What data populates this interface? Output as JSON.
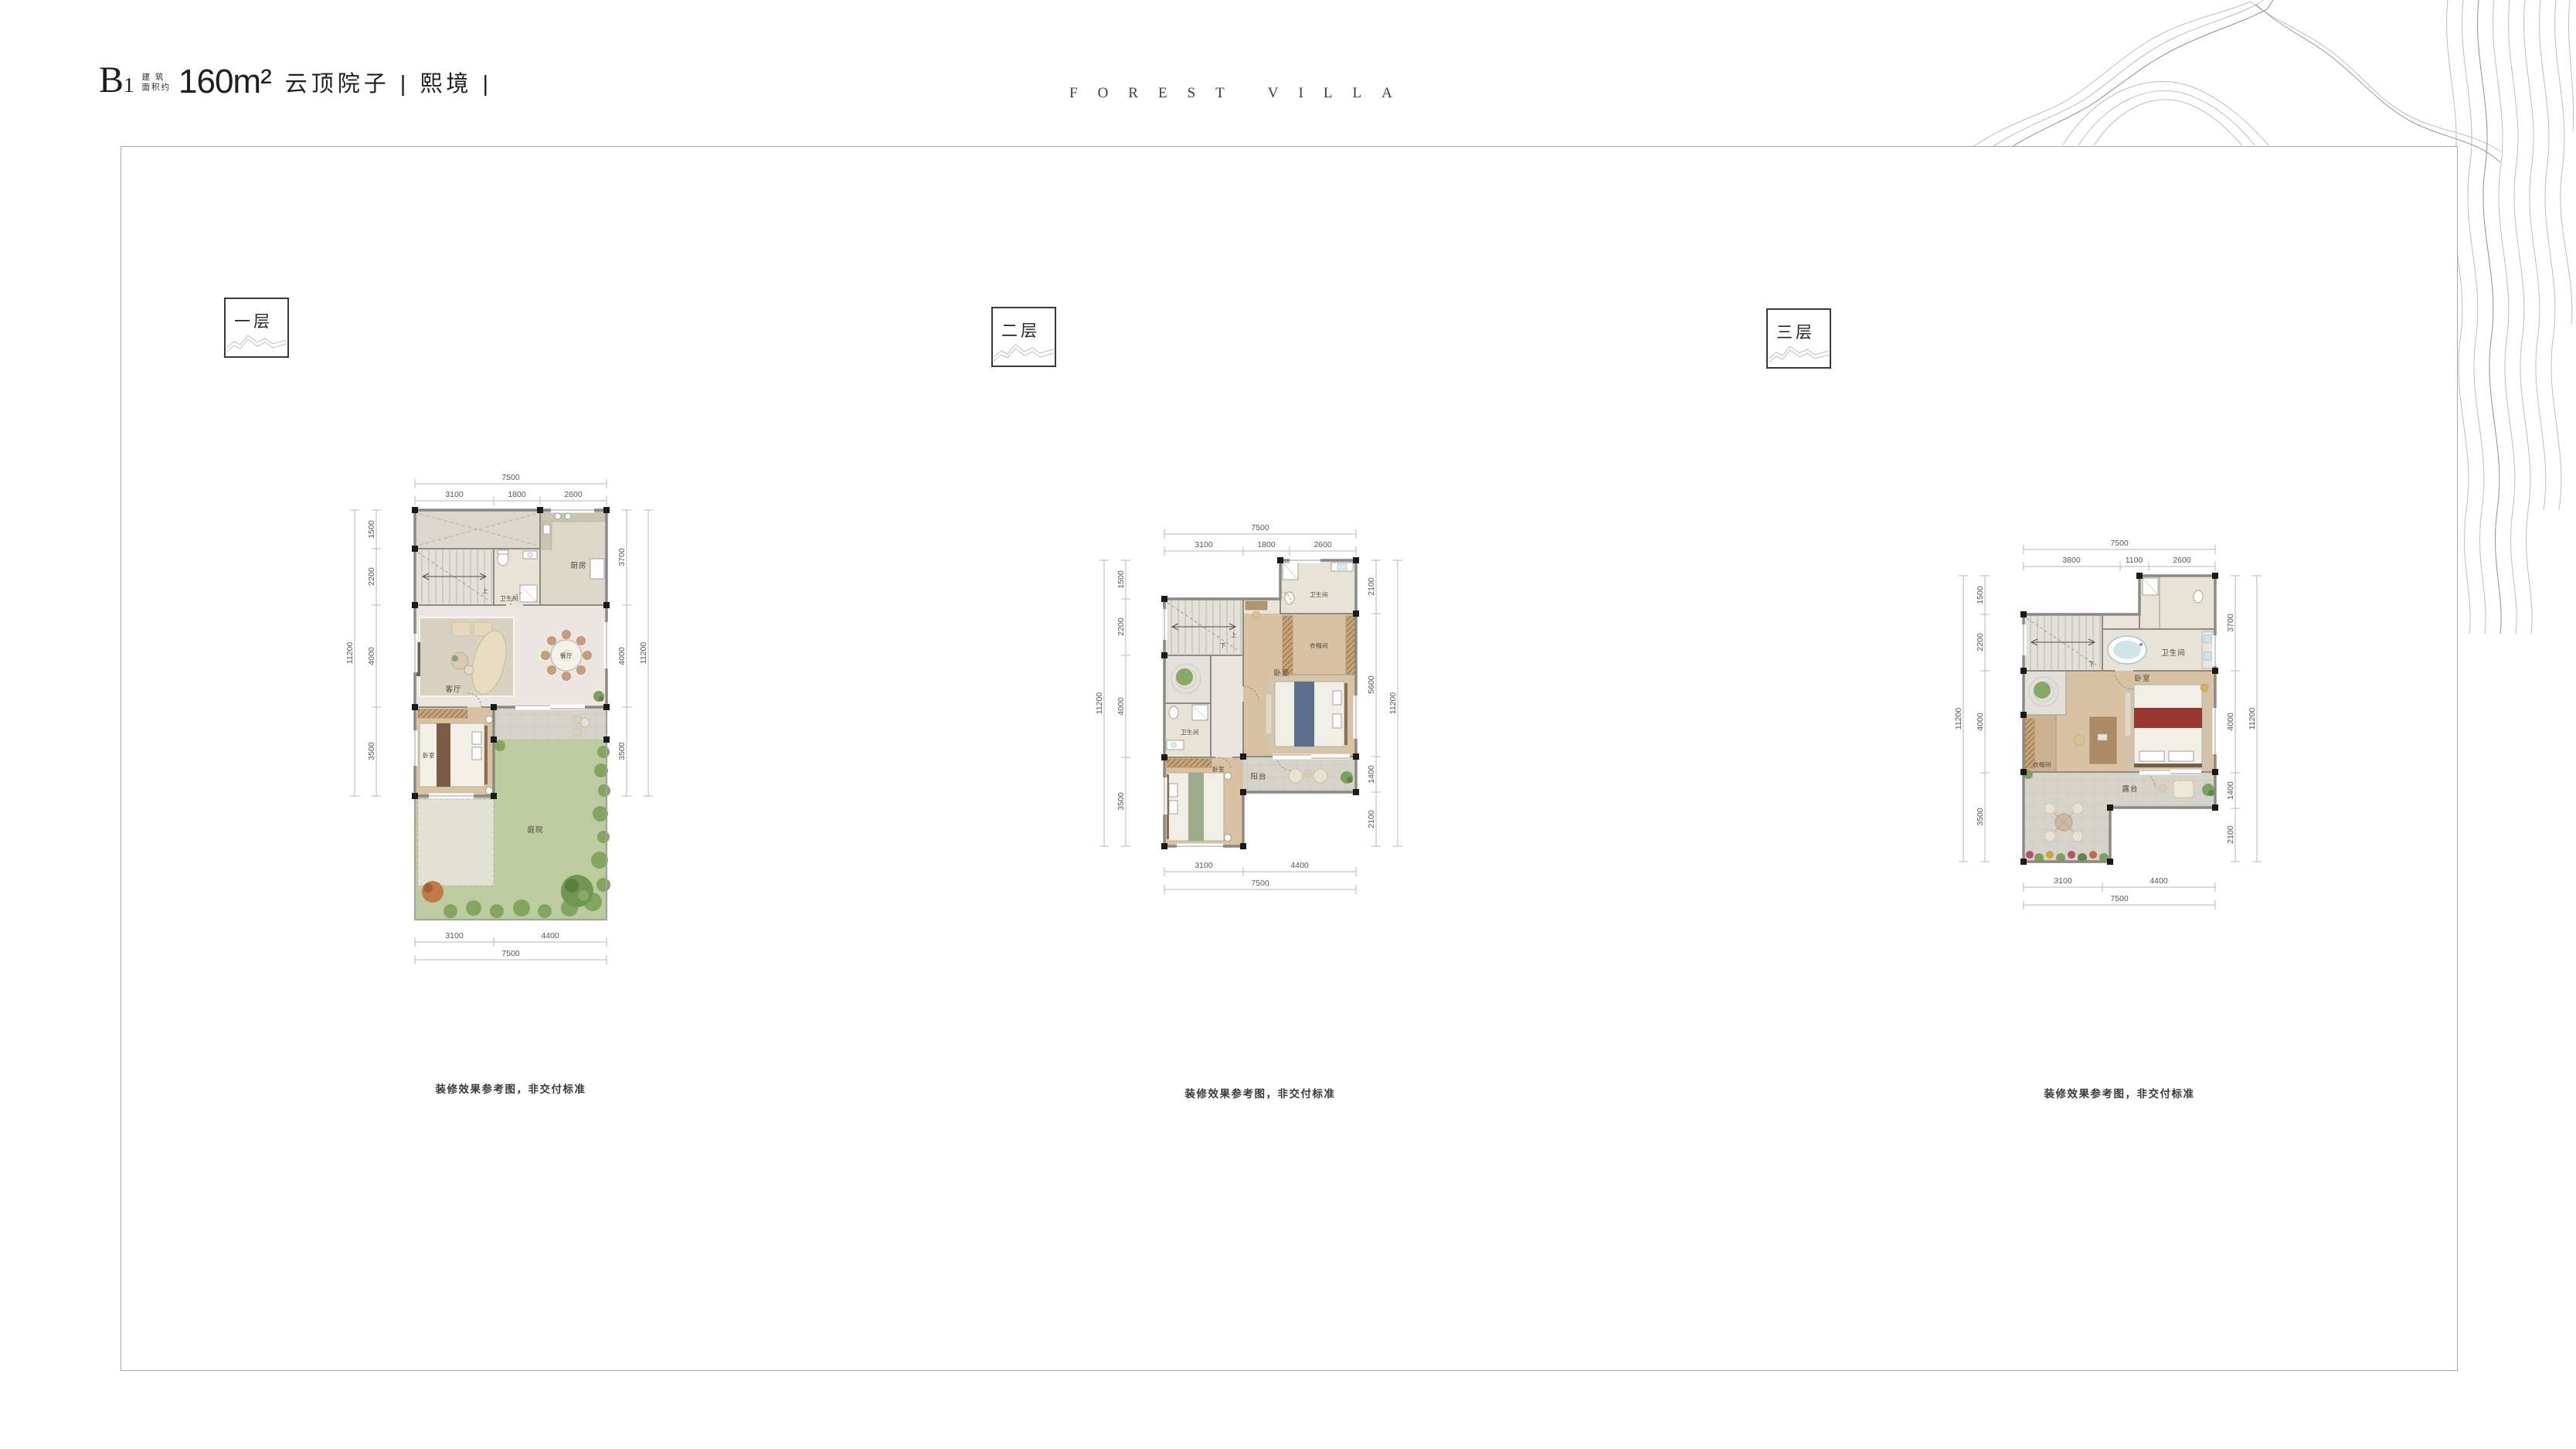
{
  "header": {
    "unit_main": "B",
    "unit_sub": "1",
    "area_note_line1": "建 筑",
    "area_note_line2": "面积约",
    "area_value": "160m²",
    "series_title": "云顶院子 | 熙境 |",
    "brand": "FOREST VILLA"
  },
  "floors": [
    {
      "label": "一层",
      "disclaimer": "装修效果参考图，非交付标准",
      "dims": {
        "top_total": "7500",
        "top_segments": [
          "3100",
          "1800",
          "2600"
        ],
        "left_total": "11200",
        "left_segments": [
          "1500",
          "2200",
          "4000",
          "3500"
        ],
        "right_total": "11200",
        "right_segments": [
          "3700",
          "4000",
          "3500"
        ],
        "bottom_segments": [
          "3100",
          "4400"
        ],
        "bottom_total": "7500"
      },
      "rooms": {
        "kitchen": "厨房",
        "bath": "卫生间",
        "stairs_up": "上",
        "living": "客厅",
        "dining": "餐厅",
        "bedroom": "卧室",
        "courtyard": "庭院"
      }
    },
    {
      "label": "二层",
      "disclaimer": "装修效果参考图，非交付标准",
      "dims": {
        "top_total": "7500",
        "top_segments": [
          "3100",
          "1800",
          "2600"
        ],
        "left_total": "11200",
        "left_segments": [
          "1500",
          "2200",
          "4000",
          "3500"
        ],
        "right_total": "11200",
        "right_segments": [
          "2100",
          "5600",
          "1400",
          "2100"
        ],
        "bottom_segments": [
          "3100",
          "4400"
        ],
        "bottom_total": "7500"
      },
      "rooms": {
        "bath_top": "卫生间",
        "closet": "衣帽间",
        "bedroom_master": "卧室",
        "stairs_up": "上",
        "stairs_down": "下",
        "bath_left": "卫生间",
        "bedroom_second": "卧室",
        "balcony": "阳台"
      }
    },
    {
      "label": "三层",
      "disclaimer": "装修效果参考图，非交付标准",
      "dims": {
        "top_total": "7500",
        "top_segments": [
          "3800",
          "1100",
          "2600"
        ],
        "left_total": "11200",
        "left_segments": [
          "1500",
          "2200",
          "4000",
          "3500"
        ],
        "right_total": "11200",
        "right_segments": [
          "3700",
          "4000",
          "1400",
          "2100"
        ],
        "bottom_segments": [
          "3100",
          "4400"
        ],
        "bottom_total": "7500"
      },
      "rooms": {
        "bath": "卫生间",
        "stairs_down": "下",
        "bedroom": "卧室",
        "closet": "衣帽间",
        "terrace": "露台"
      }
    }
  ],
  "colors": {
    "lawn_green": "#bdcba0",
    "wood_floor": "#d8c2a3",
    "tile_floor": "#ebe7e0",
    "terrace_gray": "#d6d3ca",
    "wall_gray": "#8b8781",
    "column_black": "#1a1a1a",
    "dimension_line": "#b7b7b7"
  }
}
